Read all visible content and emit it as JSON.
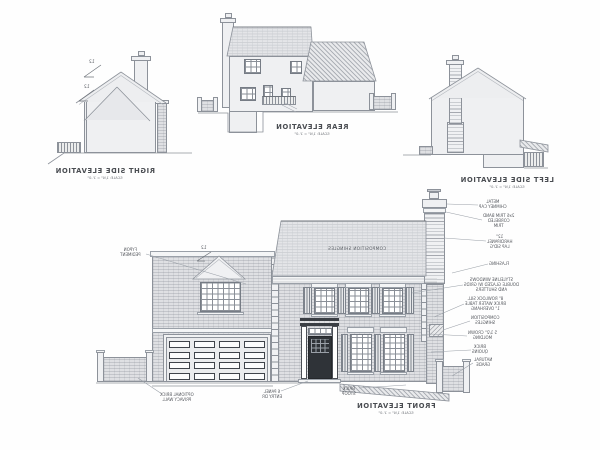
{
  "sheet": {
    "kind": "architectural elevations sheet (mirrored scan)",
    "background": "#fefefe",
    "line_color": "#8d929a",
    "dark_color": "#3a3e44"
  },
  "titles": {
    "rear": {
      "title": "REAR ELEVATION",
      "scale": "SCALE: 1/4\" = 1'-0\""
    },
    "right_side": {
      "title": "RIGHT SIDE ELEVATION",
      "scale": "SCALE: 1/4\" = 1'-0\""
    },
    "left_side": {
      "title": "LEFT SIDE ELEVATION",
      "scale": "SCALE: 1/4\" = 1'-0\""
    },
    "front": {
      "title": "FRONT ELEVATION",
      "scale": "SCALE: 1/4\" = 1'-0\""
    }
  },
  "roof_text": "COMPOSITION SHINGLES",
  "pitch_label": "12",
  "annotations": [
    {
      "id": "metal-chimney-cap",
      "lines": [
        "METAL",
        "CHIMNEY CAP"
      ],
      "x": 479,
      "y": 200,
      "lx": 478,
      "ly": 205,
      "tx": 447,
      "ty": 204
    },
    {
      "id": "trim-band",
      "lines": [
        "2x6 TRIM BAND",
        "CORBELED",
        "TRIM"
      ],
      "x": 483,
      "y": 214,
      "lx": 482,
      "ly": 220,
      "tx": 446,
      "ty": 212
    },
    {
      "id": "lap-siding",
      "lines": [
        "12\"",
        "HARDIPANEL",
        "LAP SID'G"
      ],
      "x": 487,
      "y": 235,
      "lx": 486,
      "ly": 241,
      "tx": 444,
      "ty": 238
    },
    {
      "id": "flashing",
      "lines": [
        "FLASHING"
      ],
      "x": 489,
      "y": 262,
      "lx": 488,
      "ly": 264,
      "tx": 452,
      "ty": 273
    },
    {
      "id": "windows",
      "lines": [
        "STYLELINE WINDOWS",
        "DOUBLE GLAZED W/ GRIDS",
        "AND SHUTTERS"
      ],
      "x": 464,
      "y": 278,
      "lx": 463,
      "ly": 285,
      "tx": 412,
      "ty": 293
    },
    {
      "id": "rowlock",
      "lines": [
        "8\" ROWLOCK SILL",
        "BRICK WATER TABLE",
        "1\" OVERHANG"
      ],
      "x": 465,
      "y": 297,
      "lx": 464,
      "ly": 304,
      "tx": 434,
      "ty": 317
    },
    {
      "id": "comp-shingles",
      "lines": [
        "COMPOSITION",
        "SHINGLES"
      ],
      "x": 471,
      "y": 316,
      "lx": 470,
      "ly": 321,
      "tx": 443,
      "ty": 330
    },
    {
      "id": "crown-molding",
      "lines": [
        "5 1/2\" CROWN",
        "MOLDING"
      ],
      "x": 468,
      "y": 331,
      "lx": 467,
      "ly": 336,
      "tx": 430,
      "ty": 334
    },
    {
      "id": "brick-quoins",
      "lines": [
        "BRICK",
        "QUOINS"
      ],
      "x": 472,
      "y": 345,
      "lx": 471,
      "ly": 350,
      "tx": 431,
      "ty": 352
    },
    {
      "id": "natural-grade",
      "lines": [
        "NATURAL",
        "GRADE"
      ],
      "x": 474,
      "y": 358,
      "lx": 473,
      "ly": 363,
      "tx": 452,
      "ty": 376
    },
    {
      "id": "fypon-pediment",
      "lines": [
        "FYPON",
        "PEDIMENT"
      ],
      "x": 120,
      "y": 248,
      "lx": 146,
      "ly": 254,
      "tx": 246,
      "ty": 284
    },
    {
      "id": "privacy-wall",
      "lines": [
        "OPTIONAL BRICK",
        "PRIVACY WALL"
      ],
      "x": 160,
      "y": 393,
      "lx": 162,
      "ly": 394,
      "tx": 138,
      "ty": 378
    },
    {
      "id": "entry-door",
      "lines": [
        "6 PANEL",
        "ENTRY DR"
      ],
      "x": 262,
      "y": 390,
      "lx": 281,
      "ly": 391,
      "tx": 308,
      "ty": 381
    },
    {
      "id": "brick-stoop",
      "lines": [
        "BRICK",
        "STOOP"
      ],
      "x": 342,
      "y": 387,
      "lx": 359,
      "ly": 388,
      "tx": 406,
      "ty": 385
    }
  ]
}
